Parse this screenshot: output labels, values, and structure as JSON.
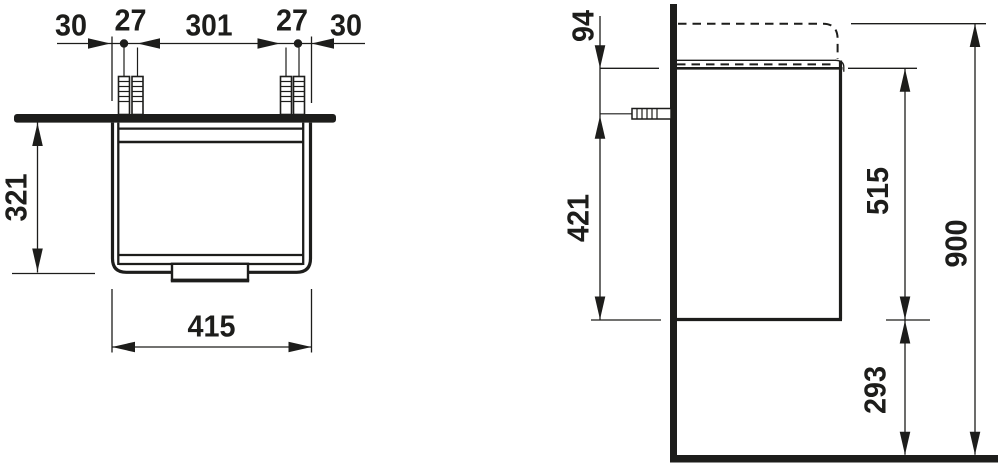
{
  "meta": {
    "type": "technical dimension drawing",
    "units": "mm",
    "views": [
      "front view",
      "side view"
    ]
  },
  "colors": {
    "ink": "#1d1d1b",
    "background": "#ffffff"
  },
  "front_view": {
    "dims": {
      "left_margin": "30",
      "left_plug_spacing": "27",
      "center_span": "301",
      "right_plug_spacing": "27",
      "right_margin": "30",
      "body_height": "321",
      "width": "415"
    }
  },
  "side_view": {
    "dims": {
      "basin_top_offset": "94",
      "plug_height_above_bottom": "421",
      "body_height": "515",
      "total_height": "900",
      "floor_clearance": "293"
    }
  }
}
